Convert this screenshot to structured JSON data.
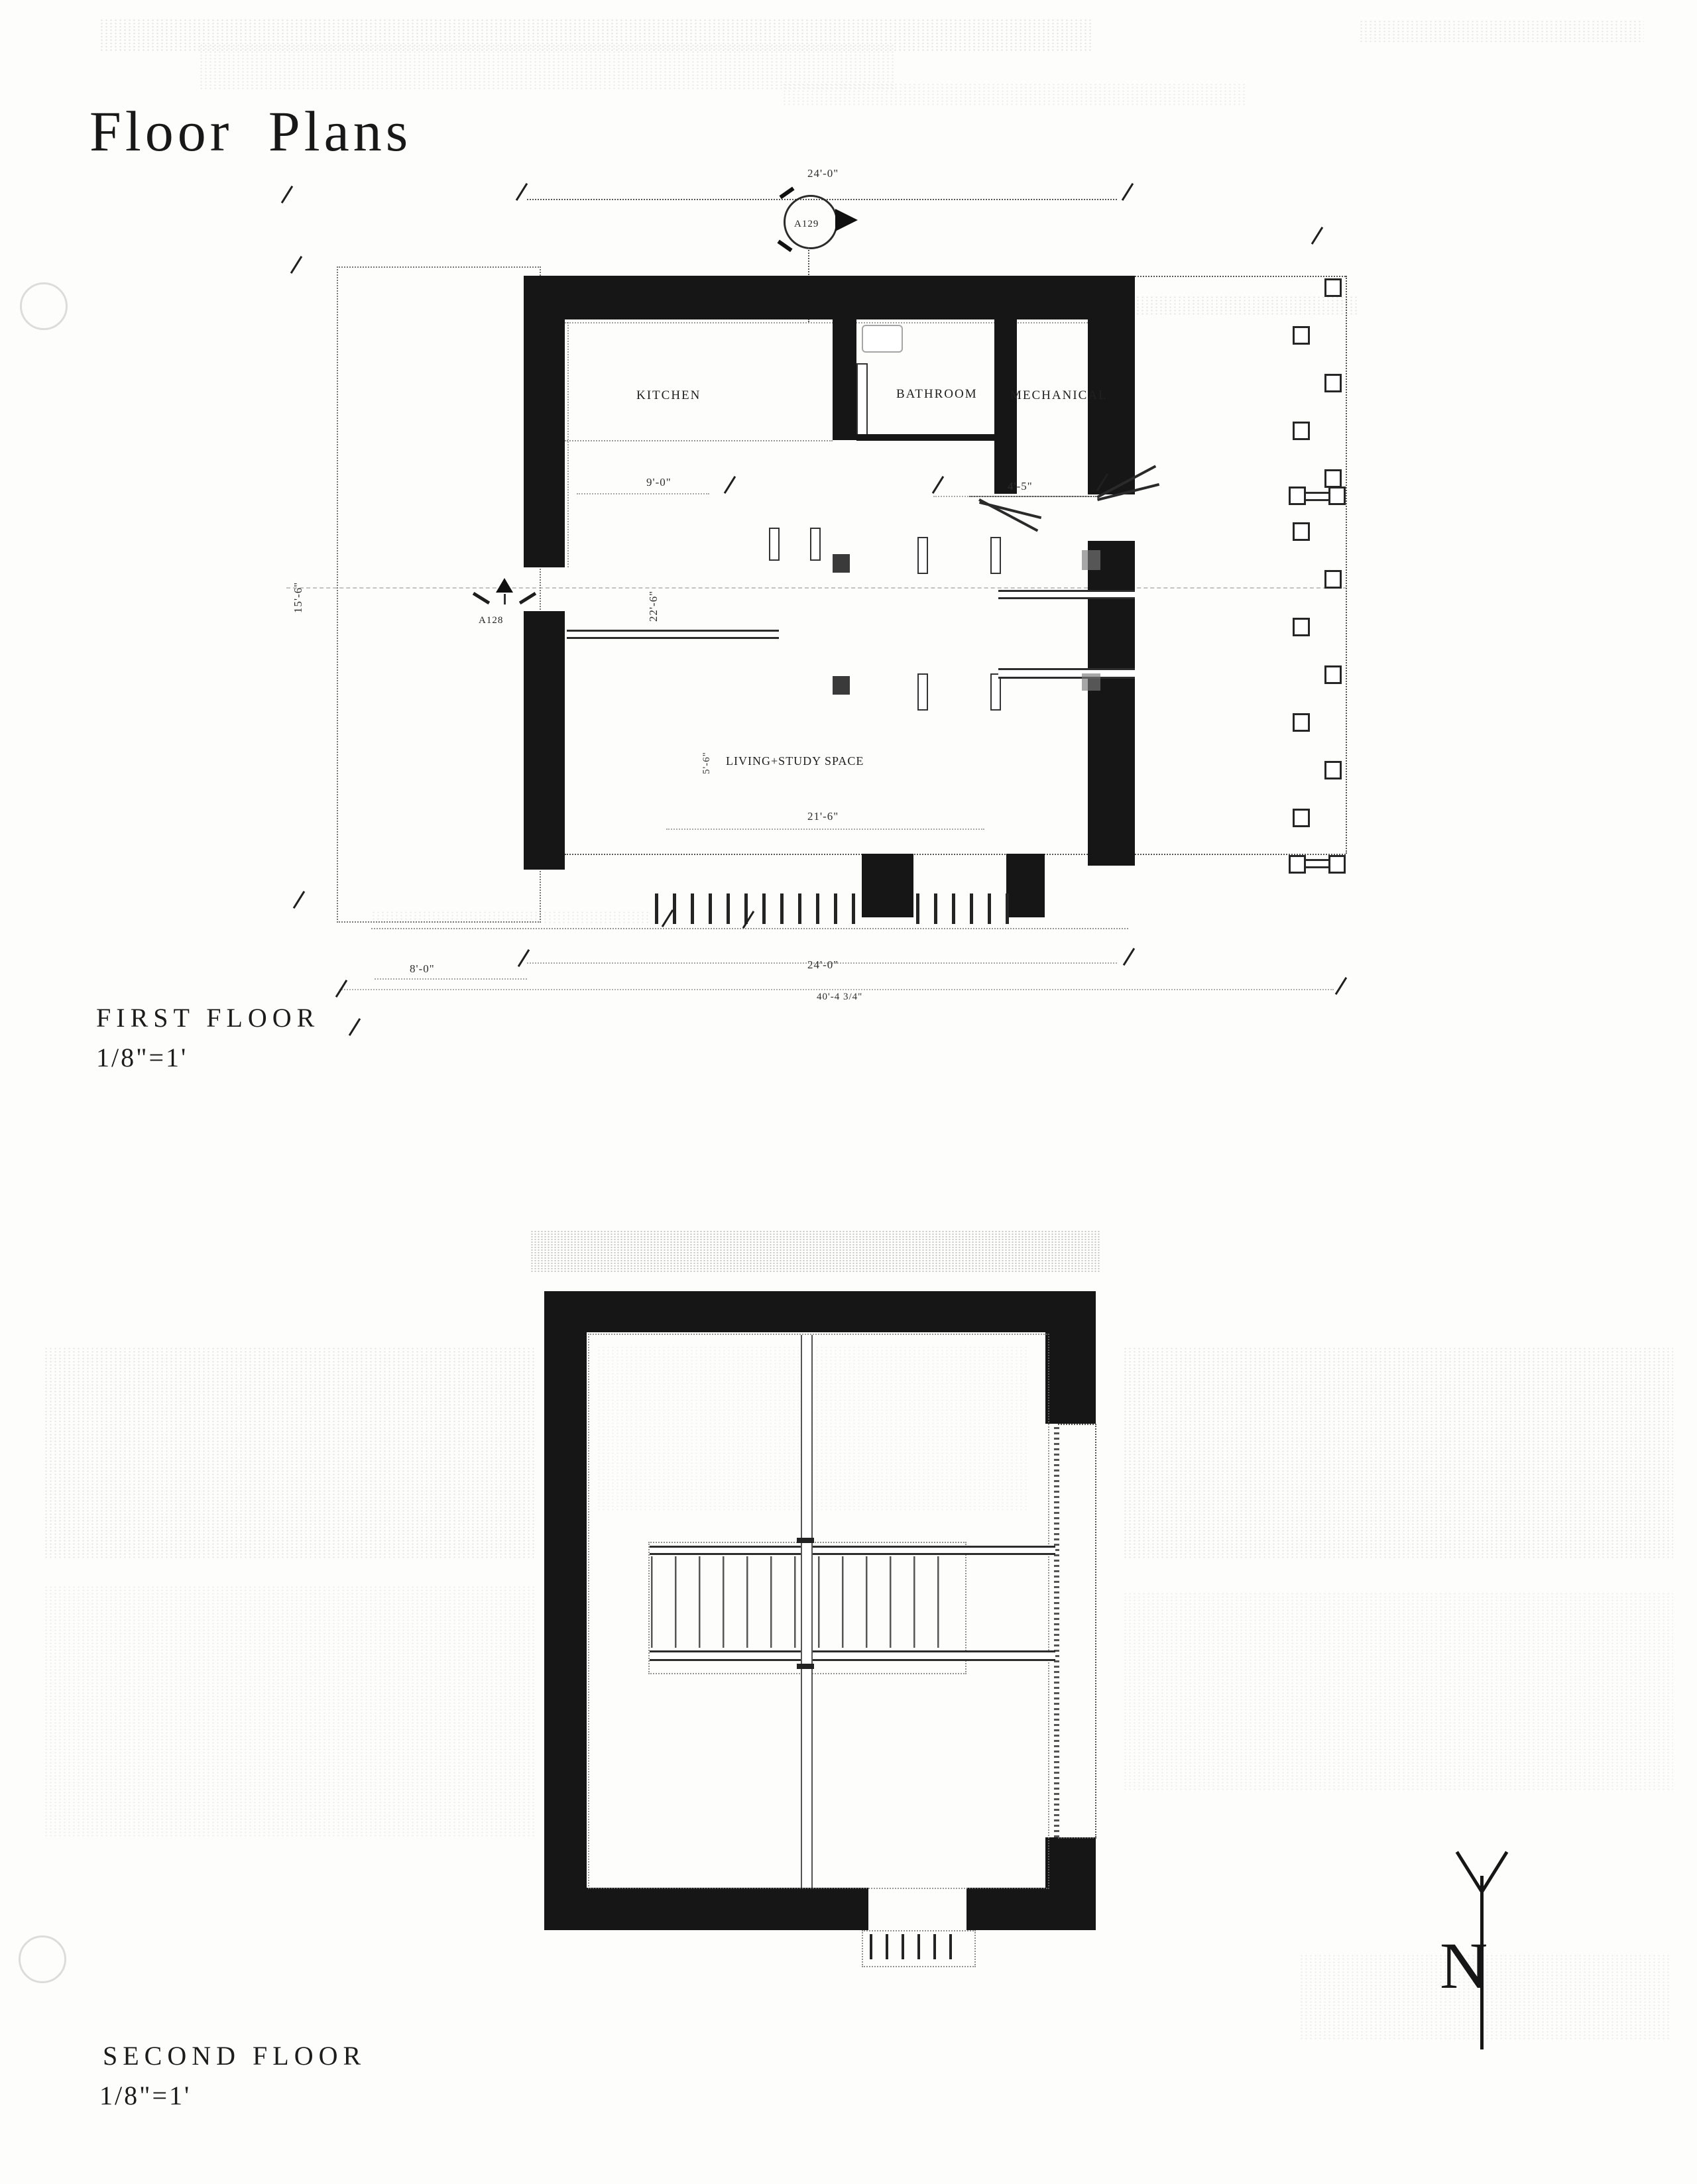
{
  "sheet": {
    "title": "Floor Plans"
  },
  "first_floor": {
    "title": "FIRST FLOOR",
    "scale": "1/8\"=1'",
    "rooms": {
      "kitchen": "KITCHEN",
      "bathroom": "BATHROOM",
      "mechanical": "MECHANICAL",
      "living": "LIVING+STUDY SPACE"
    },
    "dims": {
      "top_width": "24'-0\"",
      "kitchen": "9'-0\"",
      "bath": "4'-5\"",
      "interior": "21'-6\"",
      "bottom_width": "24'-0\"",
      "porch": "8'-0\"",
      "overall": "40'-4 3/4\"",
      "west_porch": "15'-6\"",
      "living_depth": "22'-6\"",
      "living_minor": "5'-6\""
    },
    "markers": {
      "section_top": "A129",
      "section_left": "A128"
    }
  },
  "second_floor": {
    "title": "SECOND FLOOR",
    "scale": "1/8\"=1'"
  },
  "north": {
    "label": "N"
  },
  "colors": {
    "ink": "#161616",
    "paper": "#fdfdfc"
  }
}
